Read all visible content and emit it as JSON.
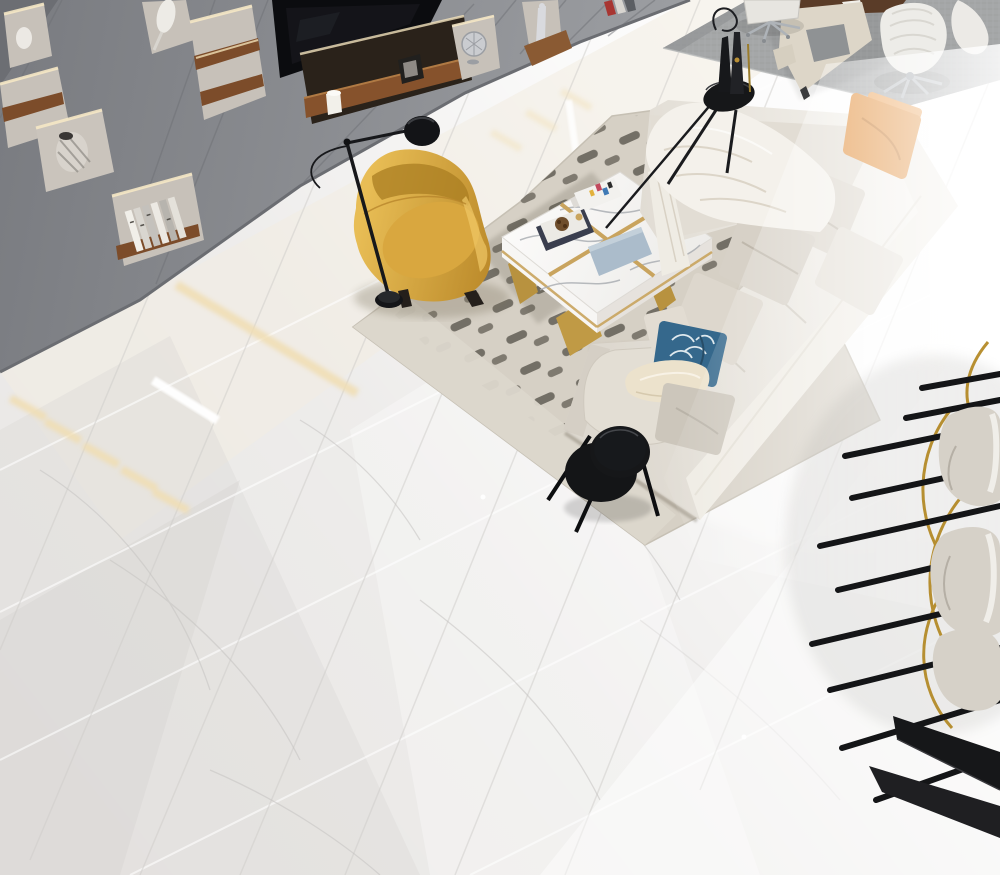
{
  "scene": {
    "type": "interior-render-photo",
    "view": "high-angle top-down view of a modern luxury living room with glossy white marble floor",
    "objects": [
      {
        "name": "bookshelf-wall",
        "label": "gray panel wall with lit display niches"
      },
      {
        "name": "tv",
        "label": "wall-mounted black television"
      },
      {
        "name": "decor-vases",
        "label": "ceramic vases on walnut shelves"
      },
      {
        "name": "decor-books",
        "label": "books standing in shelf niche"
      },
      {
        "name": "floor-lamp",
        "label": "black task floor lamp with round shade"
      },
      {
        "name": "yellow-armchair",
        "label": "yellow leather wing armchair"
      },
      {
        "name": "side-tray-table",
        "label": "small black tray table with papers"
      },
      {
        "name": "coffee-table",
        "label": "white marble coffee table with gold inlay"
      },
      {
        "name": "living-rug",
        "label": "beige rug with dark capsule pattern"
      },
      {
        "name": "sectional-sofa",
        "label": "cream L-shaped sectional sofa"
      },
      {
        "name": "throw-pillows",
        "label": "orange, beige, blue and gray pillows"
      },
      {
        "name": "throw-blanket",
        "label": "white draped throw blanket"
      },
      {
        "name": "round-end-table",
        "label": "black two-tier round end table"
      },
      {
        "name": "office-rug",
        "label": "gray woven rug in office corner"
      },
      {
        "name": "executive-desk",
        "label": "cream desk with walnut top"
      },
      {
        "name": "office-chairs",
        "label": "white swivel chairs on chrome bases"
      },
      {
        "name": "pedestal-table-sculpture",
        "label": "black round pedestal table with bottle sculpture"
      },
      {
        "name": "dining-chairs-set",
        "label": "stacked chairs with black legs and brass rods"
      },
      {
        "name": "black-side-shelf",
        "label": "black angular low table"
      },
      {
        "name": "marble-floor",
        "label": "polished white marble tile floor"
      }
    ]
  },
  "palette": {
    "floor": "#e8e6e4",
    "wall": "#8d8f94",
    "wallDark": "#6c6e73",
    "niche": "#c7c1b9",
    "glow": "#f6e8c6",
    "wood": "#7c4c2a",
    "tv": "#0b0c0f",
    "officeRug": "#a4a6a7",
    "desk": "#ddd6c8",
    "walnut": "#5a3c28",
    "chrome": "#b6bbc0",
    "rugBeige": "#d6d0c5",
    "rugDash": "#6e6a61",
    "sofa": "#e2ddd4",
    "blanket": "#f4f1eb",
    "pillowOrange": "#e2913f",
    "pillowBlue": "#35688c",
    "pillowGray": "#ccc6bb",
    "pillowCream": "#ece2cc",
    "chairYellow": "#d9a73f",
    "marble": "#f7f6f4",
    "gold": "#c9a45e",
    "goldWire": "#b0841c",
    "black": "#161719",
    "shell": "#d6d1c8",
    "bookBlue": "#abbccb"
  }
}
